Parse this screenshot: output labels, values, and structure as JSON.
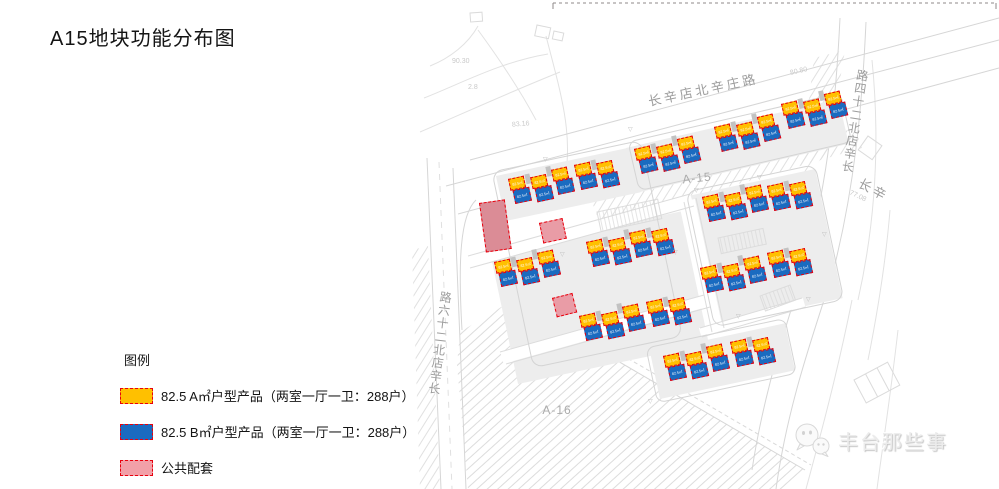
{
  "title": "A15地块功能分布图",
  "legend": {
    "heading": "图例",
    "items": [
      {
        "label": "82.5 A㎡户型产品（两室一厅一卫：288户）",
        "color": "#FFC000"
      },
      {
        "label": "82.5 B㎡户型产品（两室一厅一卫：288户）",
        "color": "#1A6BC0"
      },
      {
        "label": "公共配套",
        "color": "#F2A0A8"
      }
    ]
  },
  "map": {
    "unit_label": "82.5㎡",
    "colors": {
      "unit_a": "#FFC000",
      "unit_b": "#1A6BC0",
      "amenity": "#E99CA6",
      "amenity_large": "#DB8C96",
      "outline_red": "#E8000D"
    },
    "roads": [
      {
        "name": "长辛店北辛庄路",
        "x": 703,
        "y": 89,
        "rot": -12,
        "mode": "h"
      },
      {
        "name": "长辛店北二十四路",
        "x": 855,
        "y": 122,
        "rot": 9,
        "mode": "v"
      },
      {
        "name": "长辛店北二十六路",
        "x": 440,
        "y": 344,
        "rot": 7,
        "mode": "v"
      },
      {
        "name": "长辛",
        "x": 874,
        "y": 189,
        "rot": 28,
        "mode": "h"
      }
    ],
    "parcels": [
      {
        "label": "A-15",
        "x": 697,
        "y": 178,
        "rot": -6
      },
      {
        "label": "A-16",
        "x": 557,
        "y": 410,
        "rot": 0
      }
    ],
    "clusters": [
      {
        "x": 634,
        "y": 149,
        "rot": -13,
        "units": 3
      },
      {
        "x": 714,
        "y": 127,
        "rot": -13,
        "units": 3
      },
      {
        "x": 781,
        "y": 104,
        "rot": -13,
        "units": 3
      },
      {
        "x": 508,
        "y": 179,
        "rot": -12,
        "units": 3
      },
      {
        "x": 574,
        "y": 165,
        "rot": -12,
        "units": 2
      },
      {
        "x": 702,
        "y": 197,
        "rot": -12,
        "units": 3
      },
      {
        "x": 767,
        "y": 186,
        "rot": -12,
        "units": 2
      },
      {
        "x": 586,
        "y": 242,
        "rot": -12,
        "units": 4
      },
      {
        "x": 494,
        "y": 262,
        "rot": -12,
        "units": 3
      },
      {
        "x": 579,
        "y": 316,
        "rot": -12,
        "units": 3
      },
      {
        "x": 646,
        "y": 302,
        "rot": -12,
        "units": 2
      },
      {
        "x": 700,
        "y": 268,
        "rot": -12,
        "units": 3
      },
      {
        "x": 767,
        "y": 253,
        "rot": -12,
        "units": 2
      },
      {
        "x": 663,
        "y": 356,
        "rot": -12,
        "units": 3
      },
      {
        "x": 730,
        "y": 342,
        "rot": -12,
        "units": 2
      }
    ],
    "amenities": [
      {
        "x": 479,
        "y": 203,
        "w": 26,
        "h": 50,
        "rot": -8,
        "large": true
      },
      {
        "x": 539,
        "y": 223,
        "w": 24,
        "h": 21,
        "rot": -12,
        "large": false
      },
      {
        "x": 552,
        "y": 298,
        "w": 21,
        "h": 20,
        "rot": -14,
        "large": false
      }
    ],
    "survey_numbers": [
      {
        "text": "90.30",
        "x": 452,
        "y": 58,
        "rot": 0
      },
      {
        "text": "2.8",
        "x": 468,
        "y": 84,
        "rot": 0
      },
      {
        "text": "83.16",
        "x": 512,
        "y": 121,
        "rot": -5
      },
      {
        "text": "80.80",
        "x": 790,
        "y": 68,
        "rot": -13
      },
      {
        "text": "77.08",
        "x": 849,
        "y": 193,
        "rot": 25
      }
    ],
    "survey_mark_glyph": "▽",
    "survey_marks": [
      {
        "x": 628,
        "y": 126
      },
      {
        "x": 694,
        "y": 187
      },
      {
        "x": 757,
        "y": 174
      },
      {
        "x": 560,
        "y": 251
      },
      {
        "x": 673,
        "y": 249
      },
      {
        "x": 806,
        "y": 296
      },
      {
        "x": 736,
        "y": 313
      },
      {
        "x": 648,
        "y": 398
      },
      {
        "x": 543,
        "y": 156
      },
      {
        "x": 822,
        "y": 231
      }
    ]
  },
  "watermark": {
    "text": "丰台那些事"
  }
}
